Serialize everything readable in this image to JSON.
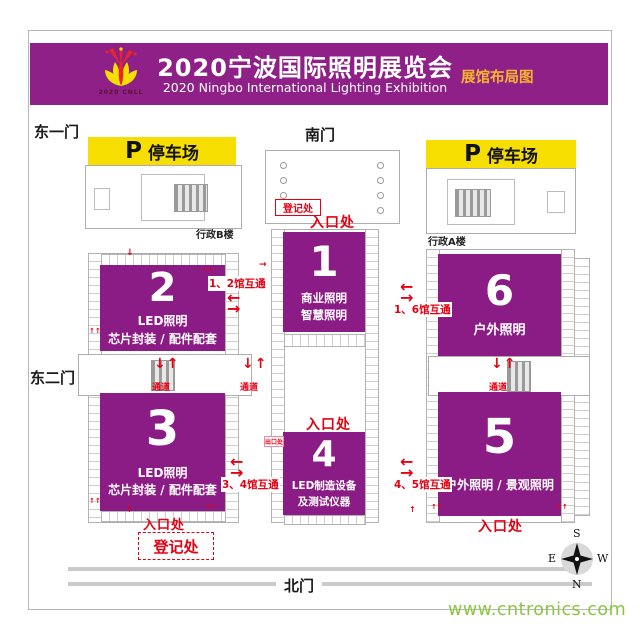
{
  "header": {
    "title": "2020宁波国际照明展览会",
    "subtitle": "2020 Ningbo International Lighting Exhibition",
    "corner_label": "展馆布局图",
    "logo_caption": "2020 CNLL"
  },
  "gates": {
    "east1": "东一门",
    "south": "南门",
    "east2": "东二门",
    "north": "北门"
  },
  "parking": {
    "p": "P",
    "label": "停车场"
  },
  "buildings": {
    "admin_b": "行政B楼",
    "admin_a": "行政A楼"
  },
  "halls": [
    {
      "no": "1",
      "line1": "商业照明",
      "line2": "智慧照明"
    },
    {
      "no": "2",
      "line1": "LED照明",
      "line2": "芯片封装 / 配件配套"
    },
    {
      "no": "3",
      "line1": "LED照明",
      "line2": "芯片封装 / 配件配套"
    },
    {
      "no": "4",
      "line1": "LED制造设备",
      "line2": "及测试仪器"
    },
    {
      "no": "5",
      "line1": "户外照明 / 景观照明",
      "line2": ""
    },
    {
      "no": "6",
      "line1": "户外照明",
      "line2": ""
    }
  ],
  "signs": {
    "entrance": "入口处",
    "registration": "登记处",
    "passage": "通道",
    "exit": "出口处",
    "interconnect_12": "1、2馆互通",
    "interconnect_16": "1、6馆互通",
    "interconnect_34": "3、4馆互通",
    "interconnect_45": "4、5馆互通"
  },
  "arrows": {
    "pair_vertical": "↓↑",
    "pair_up": "↑↑",
    "down": "↓",
    "up": "↑",
    "left": "←",
    "right": "→"
  },
  "compass": {
    "s": "S",
    "e": "E",
    "w": "W",
    "n": "N"
  },
  "watermark": "www.cntronics.com",
  "colors": {
    "banner_purple": "#8E2088",
    "hall_purple": "#8C1C85",
    "signal_red": "#E60012",
    "parking_yellow": "#F6DE00",
    "corner_yellow": "#F7B52C",
    "watermark_green": "#8CC63E"
  }
}
